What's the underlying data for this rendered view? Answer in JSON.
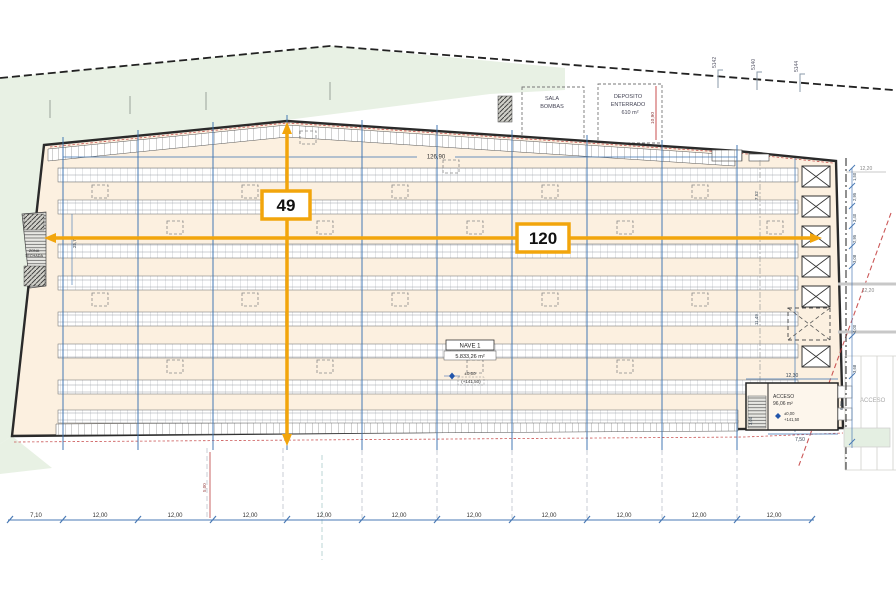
{
  "plan": {
    "type": "warehouse-site-plan",
    "colors": {
      "accent_orange": "#F2A50C",
      "grid_blue": "#3A72B0",
      "building_fill": "#FCF0E0",
      "green_area": "#E8F1E4",
      "red_line": "#C23B3B",
      "boundary_black": "#222222"
    }
  },
  "dimensions": {
    "width_label": "120",
    "height_label": "49",
    "building_length": "126,90",
    "bottom_chain": [
      "7,10",
      "12,00",
      "12,00",
      "12,00",
      "12,00",
      "12,00",
      "12,00",
      "12,00",
      "12,00",
      "12,00",
      "12,00"
    ],
    "right_chain": [
      "1,50",
      "2,95",
      "3,40",
      "2,95",
      "3,08",
      "4,00",
      "3,68"
    ],
    "right_offset_a": "12,20",
    "right_offset_b": "12,20",
    "inner_a": "7,52",
    "inner_b": "11,49",
    "ramp_length": "25,72",
    "deposito_height": "10,90",
    "below_left": "5,00",
    "acceso_top": "12,30",
    "acceso_bottom": "7,50",
    "acceso_right": "6,00",
    "acceso_left": "3,00"
  },
  "labels": {
    "sala_1": "SALA",
    "sala_2": "BOMBAS",
    "dep_1": "DEPOSITO",
    "dep_2": "ENTERRADO",
    "dep_3": "610 m²",
    "nave_name": "NAVE 1",
    "nave_area": "5.833,26 m²",
    "nave_level": "±0,00",
    "nave_level2": "(+141,50)",
    "acc_name": "ACCESO",
    "acc_area": "96,06 m²",
    "acc_level": "±0,00",
    "acc_level2": "+141,50",
    "acc_out": "ACCESO",
    "zona_1": "ZONA",
    "zona_2": "TECHADA",
    "survey_1": "5142",
    "survey_2": "5140",
    "survey_3": "5144"
  }
}
